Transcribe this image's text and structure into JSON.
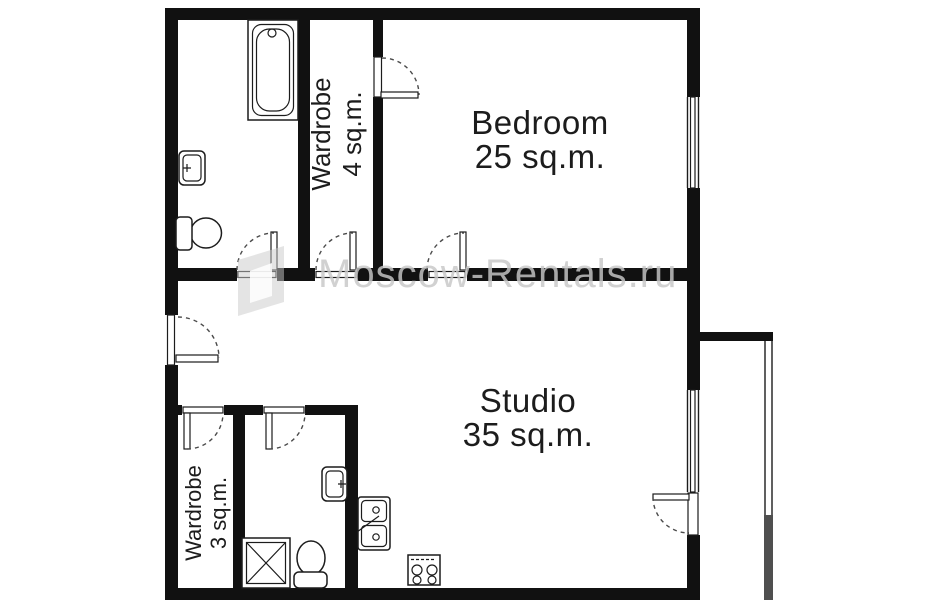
{
  "plan": {
    "title": "apartment floor plan",
    "watermark": "Moscow-Rentals.ru",
    "rooms": [
      {
        "name": "Bedroom",
        "area": "25 sq.m."
      },
      {
        "name": "Studio",
        "area": "35 sq.m."
      },
      {
        "name": "Wardrobe",
        "area": "4 sq.m."
      },
      {
        "name": "Wardrobe",
        "area": "3 sq.m."
      }
    ],
    "fixtures": [
      "bathtub",
      "wash-basin",
      "toilet",
      "shower",
      "kitchen-sink",
      "stove"
    ],
    "openings": [
      "entrance-door",
      "bathroom-door",
      "wardrobe-4-door",
      "bedroom-door",
      "wardrobe-4-bedroom-door",
      "wardrobe-3-door",
      "bathroom-2-door",
      "balcony-door",
      "bedroom-window",
      "studio-window",
      "balcony-glazing"
    ],
    "colors": {
      "wall": "#111111",
      "text": "#1c1c1c",
      "watermark": "#c8c8c8",
      "balcony_panel": "#4f4f4f"
    }
  }
}
